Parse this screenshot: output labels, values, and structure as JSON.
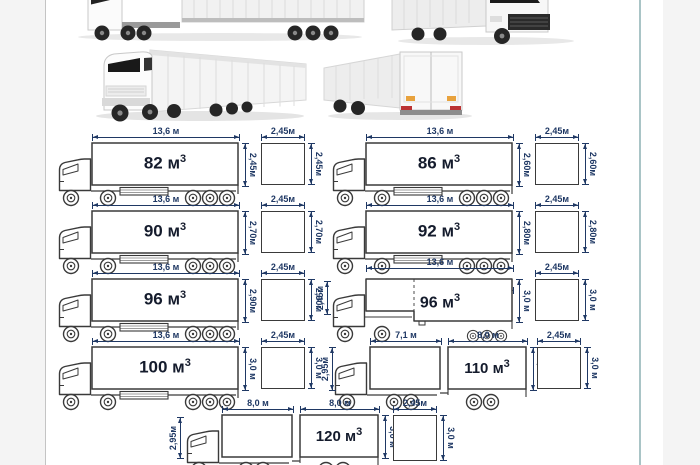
{
  "meta": {
    "description": "Truck trailer volume and dimensions infographic",
    "colors": {
      "dimension_accent": "#1f3864",
      "line_art": "#3a3a3a",
      "page_bg": "#ffffff",
      "outer_bg": "#f4f4f4",
      "right_rule": "#a9c4c6",
      "left_rule": "#c4c4c4"
    }
  },
  "photos": [
    {
      "name": "truck-side-view-photo"
    },
    {
      "name": "truck-front-quarter-photo"
    },
    {
      "name": "truck-three-quarter-photo"
    },
    {
      "name": "truck-rear-quarter-photo"
    }
  ],
  "trucks": [
    {
      "volume": "82 м",
      "sup": "3",
      "top_dim": "13,6 м",
      "height_dim": "2,45м"
    },
    {
      "volume": "86 м",
      "sup": "3",
      "top_dim": "13,6 м",
      "height_dim": "2,60м"
    },
    {
      "volume": "90 м",
      "sup": "3",
      "top_dim": "13,6 м",
      "height_dim": "2,70м"
    },
    {
      "volume": "92 м",
      "sup": "3",
      "top_dim": "13,6 м",
      "height_dim": "2,80м"
    },
    {
      "volume": "96 м",
      "sup": "3",
      "top_dim": "13,6 м",
      "height_dim": "2,90м"
    },
    {
      "volume": "96 м",
      "sup": "3",
      "top_dim": "13,6 м",
      "front_dim": "4,2 м",
      "rear_dim": "9,4 м",
      "height_dim": "3,0 м",
      "front_height_dim": "2,45м"
    },
    {
      "volume": "100 м",
      "sup": "3",
      "top_dim": "13,6 м",
      "height_dim": "3,0 м"
    },
    {
      "volume": "110 м",
      "sup": "3",
      "truck_dim": "7,1 м",
      "trailer_dim": "8,0 м",
      "height_dim": "3,0 м",
      "truck_height_dim": "2,95м"
    },
    {
      "volume": "120 м",
      "sup": "3",
      "truck_dim": "8,0 м",
      "trailer_dim": "8,0 м",
      "height_dim": "3,0 м",
      "truck_height_dim": "2,95м"
    }
  ],
  "sections": [
    {
      "width": "2,45м",
      "height": "2,45м"
    },
    {
      "width": "2,45м",
      "height": "2,60м"
    },
    {
      "width": "2,45м",
      "height": "2,70м"
    },
    {
      "width": "2,45м",
      "height": "2,80м"
    },
    {
      "width": "2,45м",
      "height": "2,90м"
    },
    {
      "width": "2,45м",
      "height": "3,0 м"
    },
    {
      "width": "2,45м",
      "height": "3,0 м"
    },
    {
      "width": "2,45м",
      "height": "3,0 м"
    },
    {
      "width": "2,45м",
      "height": "3,0 м"
    }
  ]
}
